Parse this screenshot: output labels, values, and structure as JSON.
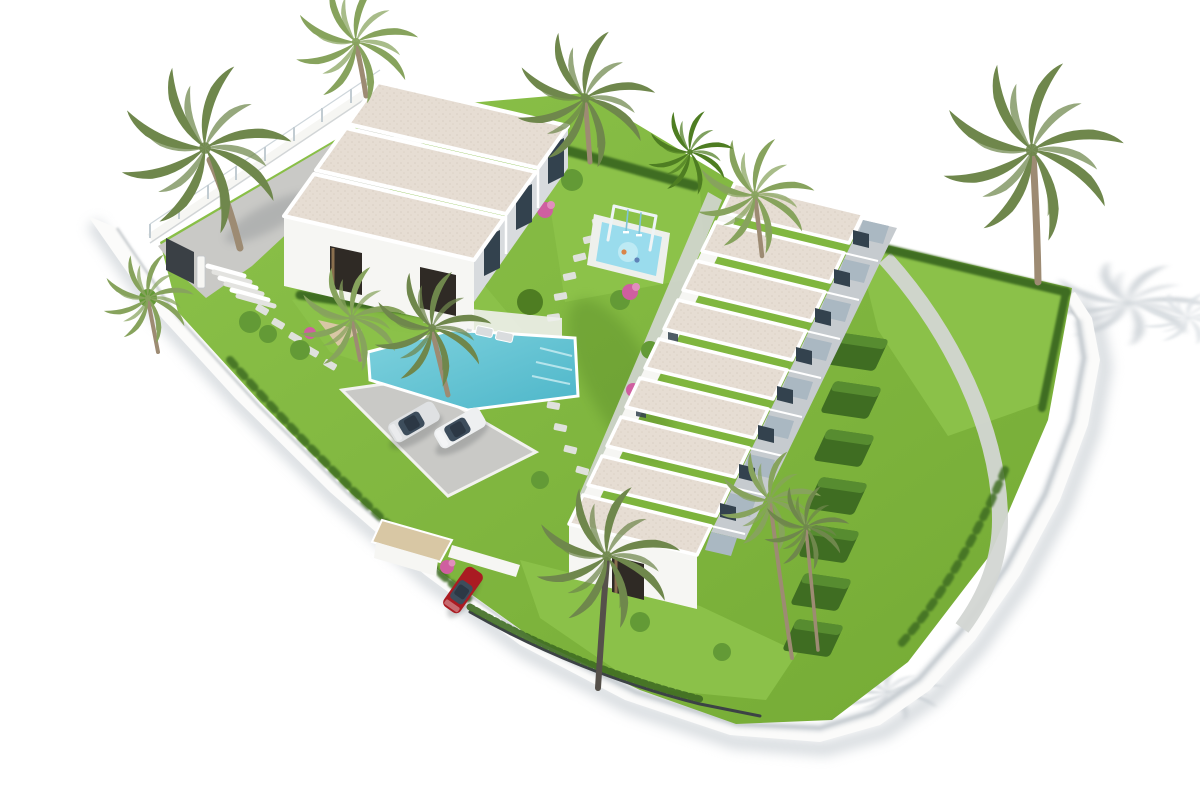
{
  "scene": {
    "type": "3d-architectural-render",
    "description": "Aerial 3D render of a white residential complex: an apartment block with three cream roof panels, a terraced row of nine townhouses with sawtooth roofs, landscaped gardens with a large turquoise pool, a children's splash pool with swing frame, a parking area with two light cars, a red car by the entrance, palm trees, hedges and a curving white perimeter road on a white background",
    "background": "#ffffff"
  },
  "inventory": {
    "apartment_roof_panels": 3,
    "townhouse_units": 9,
    "hedge_patios": 7,
    "pools": {
      "main": 1,
      "kids": 1
    },
    "cars": [
      {
        "color_name": "silver"
      },
      {
        "color_name": "white"
      },
      {
        "color_name": "red"
      }
    ],
    "palm_trees": 12
  },
  "colors": {
    "bg": "#ffffff",
    "roof-cream": "#e6ddd3",
    "roof-speck": "#d8cec2",
    "wall-white": "#f6f6f3",
    "wall-light": "#ededea",
    "wall-shade": "#d8dbde",
    "fascia-grey": "#aab8c2",
    "terrace-grey": "#c6cbcf",
    "glass-dark": "#33424e",
    "window-dark": "#2f2a25",
    "wood": "#8a6f4e",
    "grass-base": "#74aa34",
    "grass-light": "#8cc24a",
    "grass-dark": "#4e7d22",
    "hedge": "#3f6d22",
    "hedge-light": "#639a36",
    "pool": "#7fd2de",
    "pool-deep": "#4db6c9",
    "pool-kids": "#9adced",
    "deck-white": "#eef0ec",
    "pave-grey": "#c9c9c6",
    "path-grey": "#d3d6d3",
    "stone": "#dfe1dc",
    "road-white": "#fbfbfa",
    "curb": "#c3c8cb",
    "shadow": "#c9cfd4",
    "shadow-soft": "#dbe0e4",
    "trunk": "#9d8b73",
    "palm-green": "#6f874c",
    "palm-green-2": "#87a35d",
    "flower-pink": "#cf5fa0",
    "flower-pink-2": "#e18ebd",
    "car-silver": "#dfe1e3",
    "car-white": "#eef0f1",
    "car-red": "#aa1b22",
    "sand": "#d8c7a4",
    "gate-dark": "#3a4045",
    "fence-dark": "#3c4245",
    "swing-blue": "#7fc4d8",
    "post-glass": "#c2ccd2"
  }
}
